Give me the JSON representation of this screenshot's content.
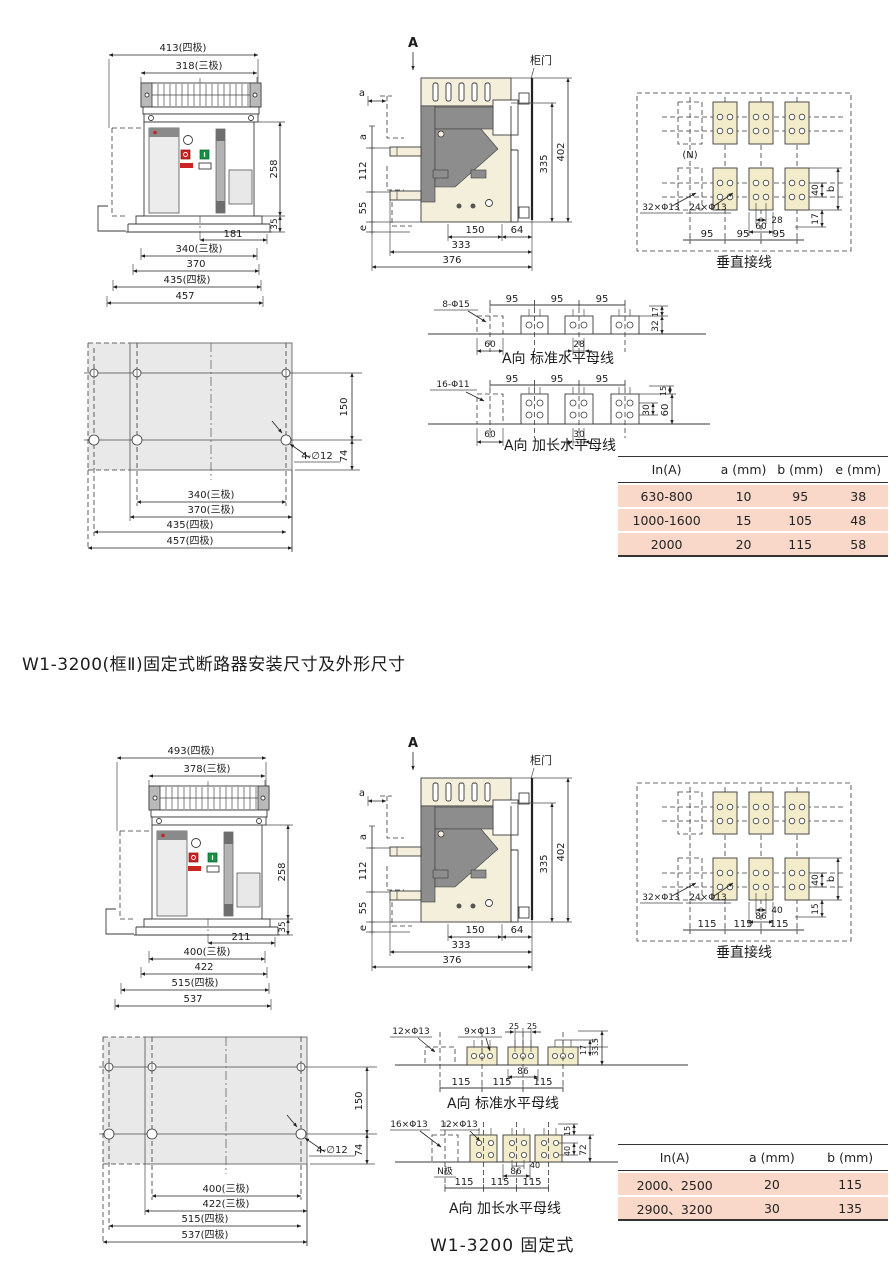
{
  "titles": {
    "section2": "W1-3200(框Ⅱ)固定式断路器安装尺寸及外形尺寸",
    "bottom_caption": "W1-3200 固定式"
  },
  "s1": {
    "f": {
      "t4": "413(四极)",
      "t3": "318(三极)",
      "h": "258",
      "h2": "35",
      "b1": "181",
      "b2": "340(三极)",
      "b3": "370",
      "b4": "435(四极)",
      "b5": "457"
    },
    "sv": {
      "a_view": "A",
      "door": "柜门",
      "a1": "a",
      "a2": "a",
      "d112": "112",
      "d55": "55",
      "e": "e",
      "d150": "150",
      "d64": "64",
      "d333": "333",
      "d376": "376",
      "d335": "335",
      "d402": "402"
    },
    "v": {
      "cap": "垂直接线",
      "n": "(N)",
      "h1": "32×Φ13",
      "h2": "24×Φ13",
      "s1": "28",
      "s2": "60",
      "p": [
        "95",
        "95",
        "95"
      ],
      "r1": "40",
      "r2": "b",
      "r3": "17"
    },
    "sb": {
      "cap": "A向 标准水平母线",
      "h": "8-Φ15",
      "p": [
        "95",
        "95",
        "95"
      ],
      "r1": "17",
      "r2": "32",
      "u1": "60",
      "u2": "28"
    },
    "eb": {
      "cap": "A向 加长水平母线",
      "h": "16-Φ11",
      "p": [
        "95",
        "95",
        "95"
      ],
      "r1": "15",
      "r2": "30",
      "r3": "60",
      "u1": "60",
      "u2": "30"
    },
    "p": {
      "v1": "150",
      "v2": "74",
      "h": "4-∅12",
      "b1": "340(三极)",
      "b2": "370(三极)",
      "b3": "435(四极)",
      "b4": "457(四极)"
    },
    "t": {
      "hd": [
        "In(A)",
        "a (mm)",
        "b (mm)",
        "e (mm)"
      ],
      "rows": [
        [
          "630-800",
          "10",
          "95",
          "38"
        ],
        [
          "1000-1600",
          "15",
          "105",
          "48"
        ],
        [
          "2000",
          "20",
          "115",
          "58"
        ]
      ]
    }
  },
  "s2": {
    "f": {
      "t4": "493(四极)",
      "t3": "378(三极)",
      "h": "258",
      "h2": "35",
      "b1": "211",
      "b2": "400(三极)",
      "b3": "422",
      "b4": "515(四极)",
      "b5": "537"
    },
    "sv": {
      "a_view": "A",
      "door": "柜门",
      "a1": "a",
      "a2": "a",
      "d112": "112",
      "d55": "55",
      "e": "e",
      "d150": "150",
      "d64": "64",
      "d333": "333",
      "d376": "376",
      "d335": "335",
      "d402": "402"
    },
    "v": {
      "cap": "垂直接线",
      "h1": "32×Φ13",
      "h2": "24×Φ13",
      "s1": "40",
      "s2": "86",
      "p": [
        "115",
        "115",
        "115"
      ],
      "r1": "40",
      "r2": "b",
      "r3": "15"
    },
    "sb": {
      "cap": "A向 标准水平母线",
      "h1": "12×Φ13",
      "h2": "9×Φ13",
      "s1": "25",
      "s2": "25",
      "r1": "17",
      "r2": "33.5",
      "u1": "86",
      "p": [
        "115",
        "115",
        "115"
      ]
    },
    "eb": {
      "cap": "A向 加长水平母线",
      "h1": "16×Φ13",
      "h2": "12×Φ13",
      "r1": "15",
      "r2": "40",
      "r3": "72",
      "n": "N极",
      "u1": "40",
      "u2": "86",
      "p": [
        "115",
        "115",
        "115"
      ]
    },
    "p": {
      "v1": "150",
      "v2": "74",
      "h": "4-∅12",
      "b1": "400(三极)",
      "b2": "422(三极)",
      "b3": "515(四极)",
      "b4": "537(四极)"
    },
    "t": {
      "hd": [
        "In(A)",
        "a (mm)",
        "b (mm)"
      ],
      "rows": [
        [
          "2000、2500",
          "20",
          "115"
        ],
        [
          "2900、3200",
          "30",
          "135"
        ]
      ]
    }
  }
}
